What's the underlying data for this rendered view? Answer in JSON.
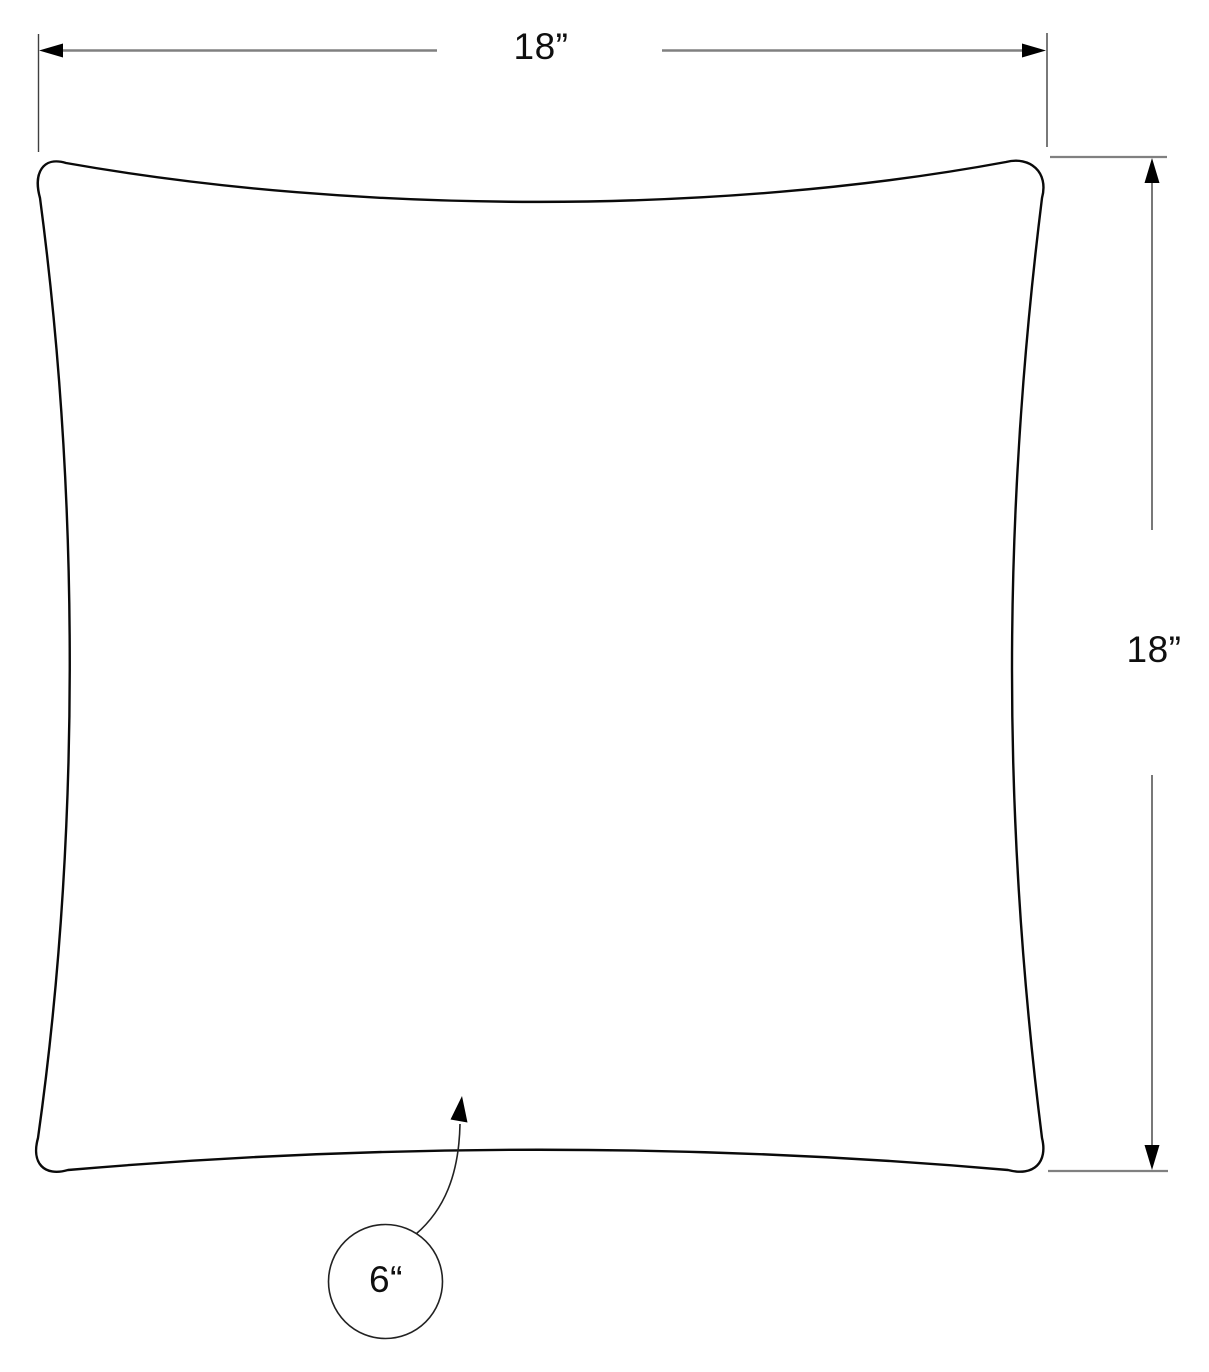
{
  "diagram": {
    "labels": {
      "width": "18”",
      "height": "18”",
      "callout": "6“"
    },
    "colors": {
      "outline": "#0a0a0a",
      "dimension_line": "#808080",
      "extension_line": "#3f3f3f",
      "arrowhead": "#000000",
      "leader_line": "#222222",
      "background": "#ffffff",
      "text": "#0f0f0f"
    }
  }
}
